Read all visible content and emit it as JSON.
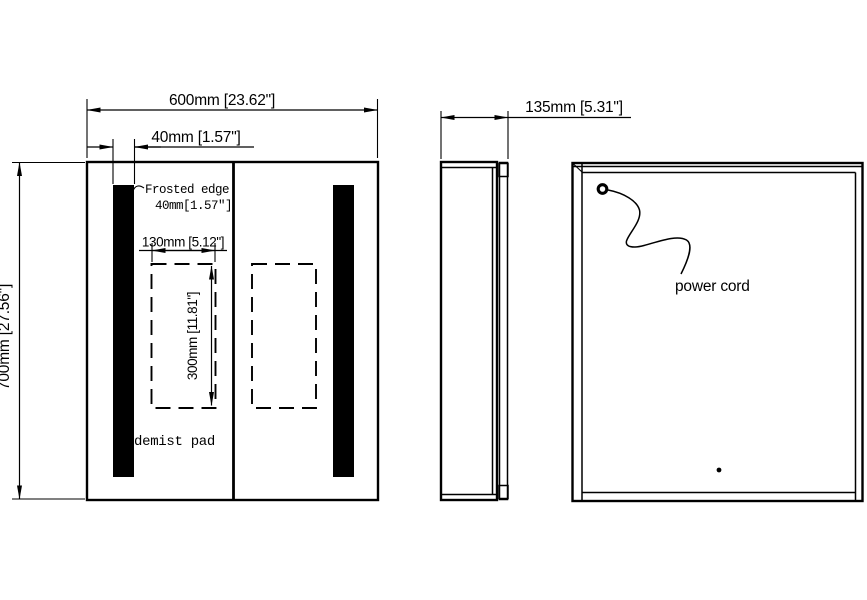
{
  "views": {
    "front": {
      "width_dim": "600mm [23.62\"]",
      "strip_dim": "40mm [1.57\"]",
      "height_dim": "700mm [27.56\"]",
      "frosted_label_line1": "Frosted edge",
      "frosted_label_line2": "40mm[1.57″]",
      "pad_width_dim": "130mm [5.12\"]",
      "pad_height_dim": "300mm [11.81\"]",
      "demist_label": "demist pad"
    },
    "side": {
      "depth_dim": "135mm [5.31\"]"
    },
    "back": {
      "power_cord_label": "power cord"
    }
  },
  "colors": {
    "line": "#000000",
    "background": "#ffffff",
    "strip_fill": "#000000"
  }
}
